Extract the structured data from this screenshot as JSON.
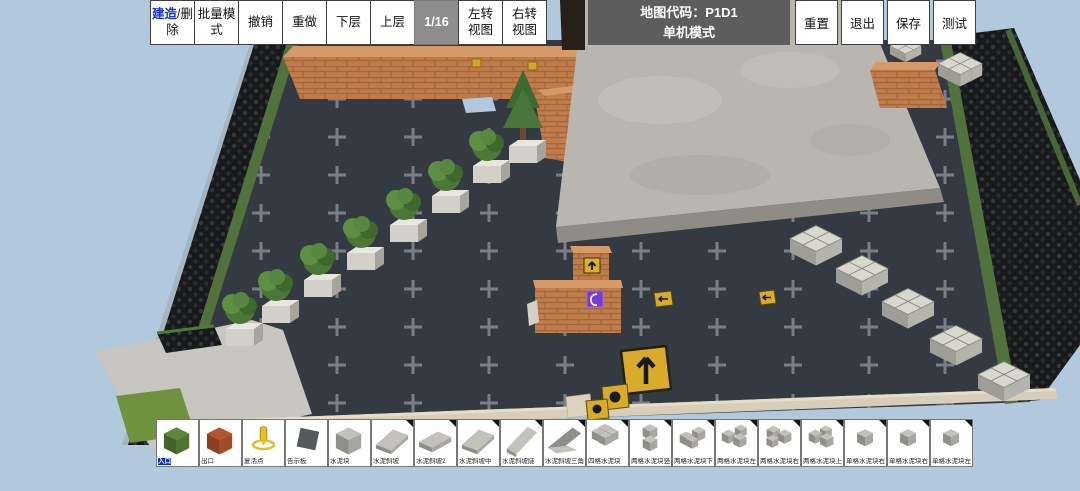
{
  "toolbar": {
    "build_delete": {
      "highlight": "建造",
      "rest": "/删除"
    },
    "left_buttons": [
      {
        "label": "批量模\n式"
      },
      {
        "label": "撤销"
      },
      {
        "label": "重做"
      },
      {
        "label": "下层"
      },
      {
        "label": "上层"
      }
    ],
    "layer_indicator": "1/16",
    "view_buttons": [
      {
        "label": "左转\n视图"
      },
      {
        "label": "右转\n视图"
      }
    ],
    "title_line1": "地图代码：P1D1",
    "title_line2": "单机模式",
    "right_buttons": [
      {
        "label": "重置"
      },
      {
        "label": "退出"
      },
      {
        "label": "保存"
      },
      {
        "label": "测试"
      }
    ]
  },
  "palette": {
    "items": [
      {
        "label": "入口",
        "icon": "cube",
        "color": "green",
        "selected": true
      },
      {
        "label": "出口",
        "icon": "cube",
        "color": "red"
      },
      {
        "label": "复活点",
        "icon": "pin",
        "color": "yellow"
      },
      {
        "label": "告示板",
        "icon": "board",
        "color": "dark"
      },
      {
        "label": "水泥块",
        "icon": "cube",
        "color": "gray"
      },
      {
        "label": "水泥斜坡",
        "icon": "slope",
        "color": "gray",
        "corner": true
      },
      {
        "label": "水泥斜坡2",
        "icon": "slope2",
        "color": "gray",
        "corner": true
      },
      {
        "label": "水泥斜坡中",
        "icon": "slope",
        "color": "gray",
        "corner": true
      },
      {
        "label": "水泥斜坡陡",
        "icon": "slope3",
        "color": "gray",
        "corner": true
      },
      {
        "label": "水泥斜坡三角",
        "icon": "wedge",
        "color": "gray",
        "corner": true
      },
      {
        "label": "四格水泥块",
        "icon": "grid4",
        "color": "gray",
        "corner": true
      },
      {
        "label": "两格水泥块竖",
        "icon": "grid2v",
        "color": "gray",
        "corner": true
      },
      {
        "label": "两格水泥块下",
        "icon": "grid2d",
        "color": "gray",
        "corner": true
      },
      {
        "label": "两格水泥块左",
        "icon": "grid2l",
        "color": "gray",
        "corner": true
      },
      {
        "label": "两格水泥块右",
        "icon": "grid2r",
        "color": "gray",
        "corner": true
      },
      {
        "label": "两格水泥块上",
        "icon": "grid2u",
        "color": "gray",
        "corner": true
      },
      {
        "label": "单格水泥块右上",
        "icon": "grid1",
        "color": "gray",
        "corner": true
      },
      {
        "label": "单格水泥块右下",
        "icon": "grid1",
        "color": "gray",
        "corner": true
      },
      {
        "label": "单格水泥块左下",
        "icon": "grid1",
        "color": "gray",
        "corner": true
      }
    ],
    "color_map": {
      "green": {
        "top": "#5d8639",
        "left": "#43632a",
        "right": "#51752f"
      },
      "red": {
        "top": "#b5552f",
        "left": "#8d3f22",
        "right": "#a34a28"
      },
      "gray": {
        "top": "#c2c2ba",
        "left": "#8f8f89",
        "right": "#a7a7a0"
      },
      "dark": {
        "top": "#555a5e",
        "left": "#44484c",
        "right": "#4d5155"
      },
      "yellow": {
        "top": "#e8c028",
        "left": "#b8941a",
        "right": "#d2ab20"
      }
    }
  },
  "colors": {
    "sky": "#b2c8dc",
    "asphalt": "#343a41",
    "cross_marks": "#8e959d",
    "brick": "#c07b4a",
    "concrete_slab": "#b9b6b0",
    "accent_blue": "#1635cd",
    "selected_label_bg": "#0a2ed0",
    "sign_yellow": "#d9ab2b",
    "marker_purple": "#7a3bd0",
    "layer_badge_bg": "#8d8d8d"
  }
}
